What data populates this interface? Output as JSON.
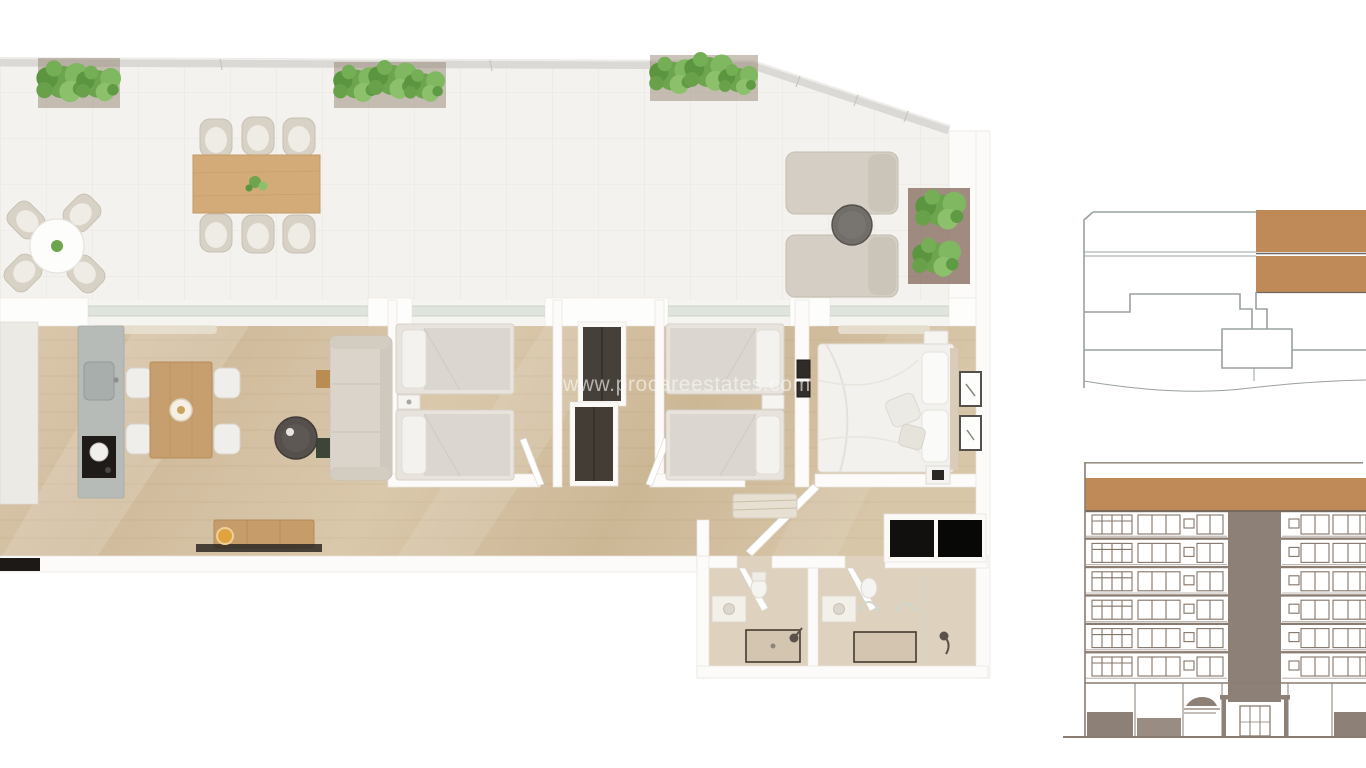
{
  "page": {
    "watermark": "www.procareestates.com",
    "background": "#ffffff"
  },
  "palette": {
    "accent_brown": "#bf8a57",
    "elevation_line": "#8a7c70",
    "elevation_core": "#8d8076",
    "plan_outline": "#9aa0a2",
    "wood_floor": "#d5c1a3",
    "terrace_tile": "#f4f2ee",
    "bath_floor": "#ded1be",
    "wall_white": "#fcfbf9",
    "wardrobe_dark": "#46403a",
    "kitchen_island_gray": "#b7bbb8",
    "sofa_beige": "#dad4ca",
    "plant_green": "#7cb25b",
    "watermark_color": "rgba(250,249,246,0.62)"
  },
  "floor_plan": {
    "description": "3D top-down render of an apartment",
    "rooms": [
      "terrace",
      "kitchen-dining",
      "living-room",
      "bedroom-1",
      "bedroom-2",
      "master-bedroom",
      "hallway",
      "bathroom-1",
      "bathroom-2"
    ],
    "terrace_furniture": [
      "dining-table-with-6-chairs",
      "bistro-table-with-4-chairs",
      "two-loungers-with-side-table",
      "four-planters"
    ],
    "bedroom_1_beds": 2,
    "bedroom_2_beds": 2,
    "master_beds": 1,
    "bathrooms": 2
  },
  "key_plan": {
    "type": "building-key-plan",
    "highlighted_units": 2,
    "highlight_color": "#bf8a57"
  },
  "elevation": {
    "type": "building-front-elevation",
    "floors": 6,
    "roof_band_color": "#bf8a57",
    "has_central_core": true
  }
}
